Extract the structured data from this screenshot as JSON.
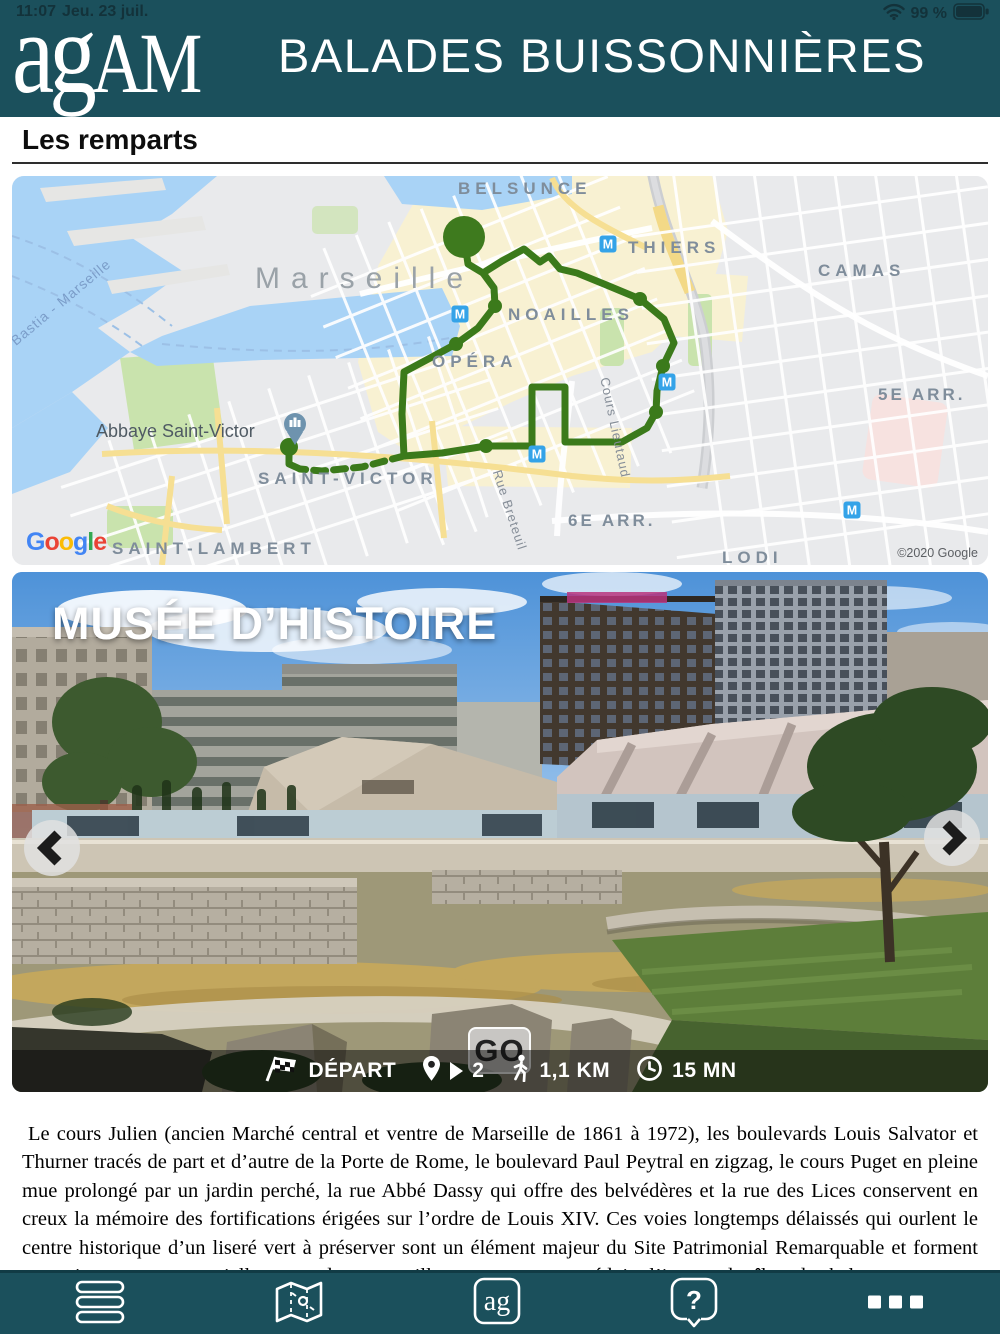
{
  "status_bar": {
    "time": "11:07",
    "date": "Jeu. 23 juil.",
    "battery_percent": "99 %",
    "icons": {
      "wifi": "wifi-icon",
      "battery": "battery-icon"
    }
  },
  "header": {
    "logo_ag": "ag",
    "logo_am": "AM",
    "app_title": "BALADES BUISSONNIÈRES"
  },
  "section": {
    "title": "Les remparts"
  },
  "map": {
    "labels": {
      "city": "Marseille",
      "belsunce": "BELSUNCE",
      "thiers": "THIERS",
      "camas": "CAMAS",
      "noailles": "NOAILLES",
      "opera": "OPÉRA",
      "saint_victor": "SAINT-VICTOR",
      "saint_lambert": "SAINT-LAMBERT",
      "lodi": "LODI",
      "arr5": "5E ARR.",
      "arr6": "6E ARR.",
      "abbaye": "Abbaye Saint-Victor",
      "ferry": "Bastia - Marseille",
      "cours_lieutaud": "Cours Lieutaud",
      "rue_breteuil": "Rue Breteuil"
    },
    "metro_letter": "M",
    "attribution": "©2020 Google",
    "google_letters": [
      {
        "ch": "G",
        "color": "#4285F4"
      },
      {
        "ch": "o",
        "color": "#EA4335"
      },
      {
        "ch": "o",
        "color": "#FBBC05"
      },
      {
        "ch": "g",
        "color": "#4285F4"
      },
      {
        "ch": "l",
        "color": "#34A853"
      },
      {
        "ch": "e",
        "color": "#EA4335"
      }
    ],
    "icons": {
      "metro": "metro-badge-icon",
      "poi": "abbey-poi-pin-icon",
      "route_start": "route-start-marker",
      "route_end": "route-end-marker"
    }
  },
  "carousel": {
    "photo_title": "MUSÉE D’HISTOIRE",
    "building_sign": "CENTRE BOURSE",
    "go_label": "GO",
    "info": {
      "depart": "DÉPART",
      "waypoint_count": "2",
      "distance": "1,1 KM",
      "duration": "15 MN"
    },
    "icons": {
      "prev": "chevron-left-icon",
      "next": "chevron-right-icon",
      "flag": "checkered-flag-icon",
      "pin": "map-pin-icon",
      "play": "play-icon",
      "walker": "walking-person-icon",
      "clock": "clock-icon"
    }
  },
  "article": {
    "body": "Le cours Julien (ancien Marché central et ventre de Marseille de 1861 à 1972), les boulevards Louis Salvator et Thurner tracés de part et d’autre de la Porte de Rome, le boulevard Paul Peytral en zigzag, le cours Puget en pleine mue prolongé par un jardin perché, la rue Abbé Dassy qui offre des belvédères et la rue des Lices conservent en creux la mémoire des fortifications érigées sur l’ordre de Louis XIV. Ces voies longtemps délaissés qui ourlent le centre historique d’un liseré vert à préserver sont un élément majeur du Site Patrimonial Remarquable et forment une ceinture verte essentielle autour du centre-ville notamment pour réduire l’impact des îlots de chaleur."
  },
  "toolbar": {
    "ag_badge": "ag",
    "help_glyph": "?",
    "icons": {
      "list": "list-icon",
      "map": "map-icon",
      "agam": "agam-badge-icon",
      "help": "help-bubble-icon",
      "more": "more-dots-icon"
    }
  },
  "colors": {
    "header_teal": "#1b505c",
    "route_green": "#3b7a1b",
    "metro_blue": "#34a3e8",
    "map_water": "#a9d3f6",
    "map_cream": "#f8f1d2",
    "park_green": "#c9e3ad"
  }
}
